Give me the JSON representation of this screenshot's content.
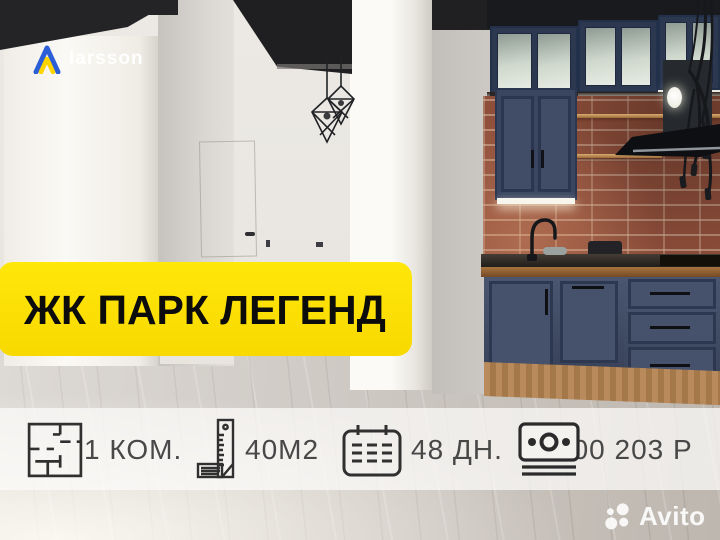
{
  "logo": {
    "brand": "larsson"
  },
  "banner": {
    "title": "ЖК ПАРК ЛЕГЕНД"
  },
  "info_bar": {
    "items": [
      {
        "icon": "floor-plan-icon",
        "label": "1 КОМ."
      },
      {
        "icon": "ruler-icon",
        "label": "40М2"
      },
      {
        "icon": "calendar-icon",
        "label": "48 ДН."
      },
      {
        "icon": "money-icon",
        "label": "800 203 Р"
      }
    ]
  },
  "watermark": {
    "brand": "Avito"
  },
  "colors": {
    "banner_bg": "#ffe000",
    "banner_text": "#0c0c0c",
    "info_bar_bg": "rgba(252,251,249,0.74)",
    "info_bar_text": "#484848",
    "logo_blue": "#2b5ed7",
    "logo_yellow": "#ffd400",
    "cabinet_blue": "#41506b",
    "brick_red": "#8e4e3a",
    "ceiling_black": "#1f1f22"
  }
}
